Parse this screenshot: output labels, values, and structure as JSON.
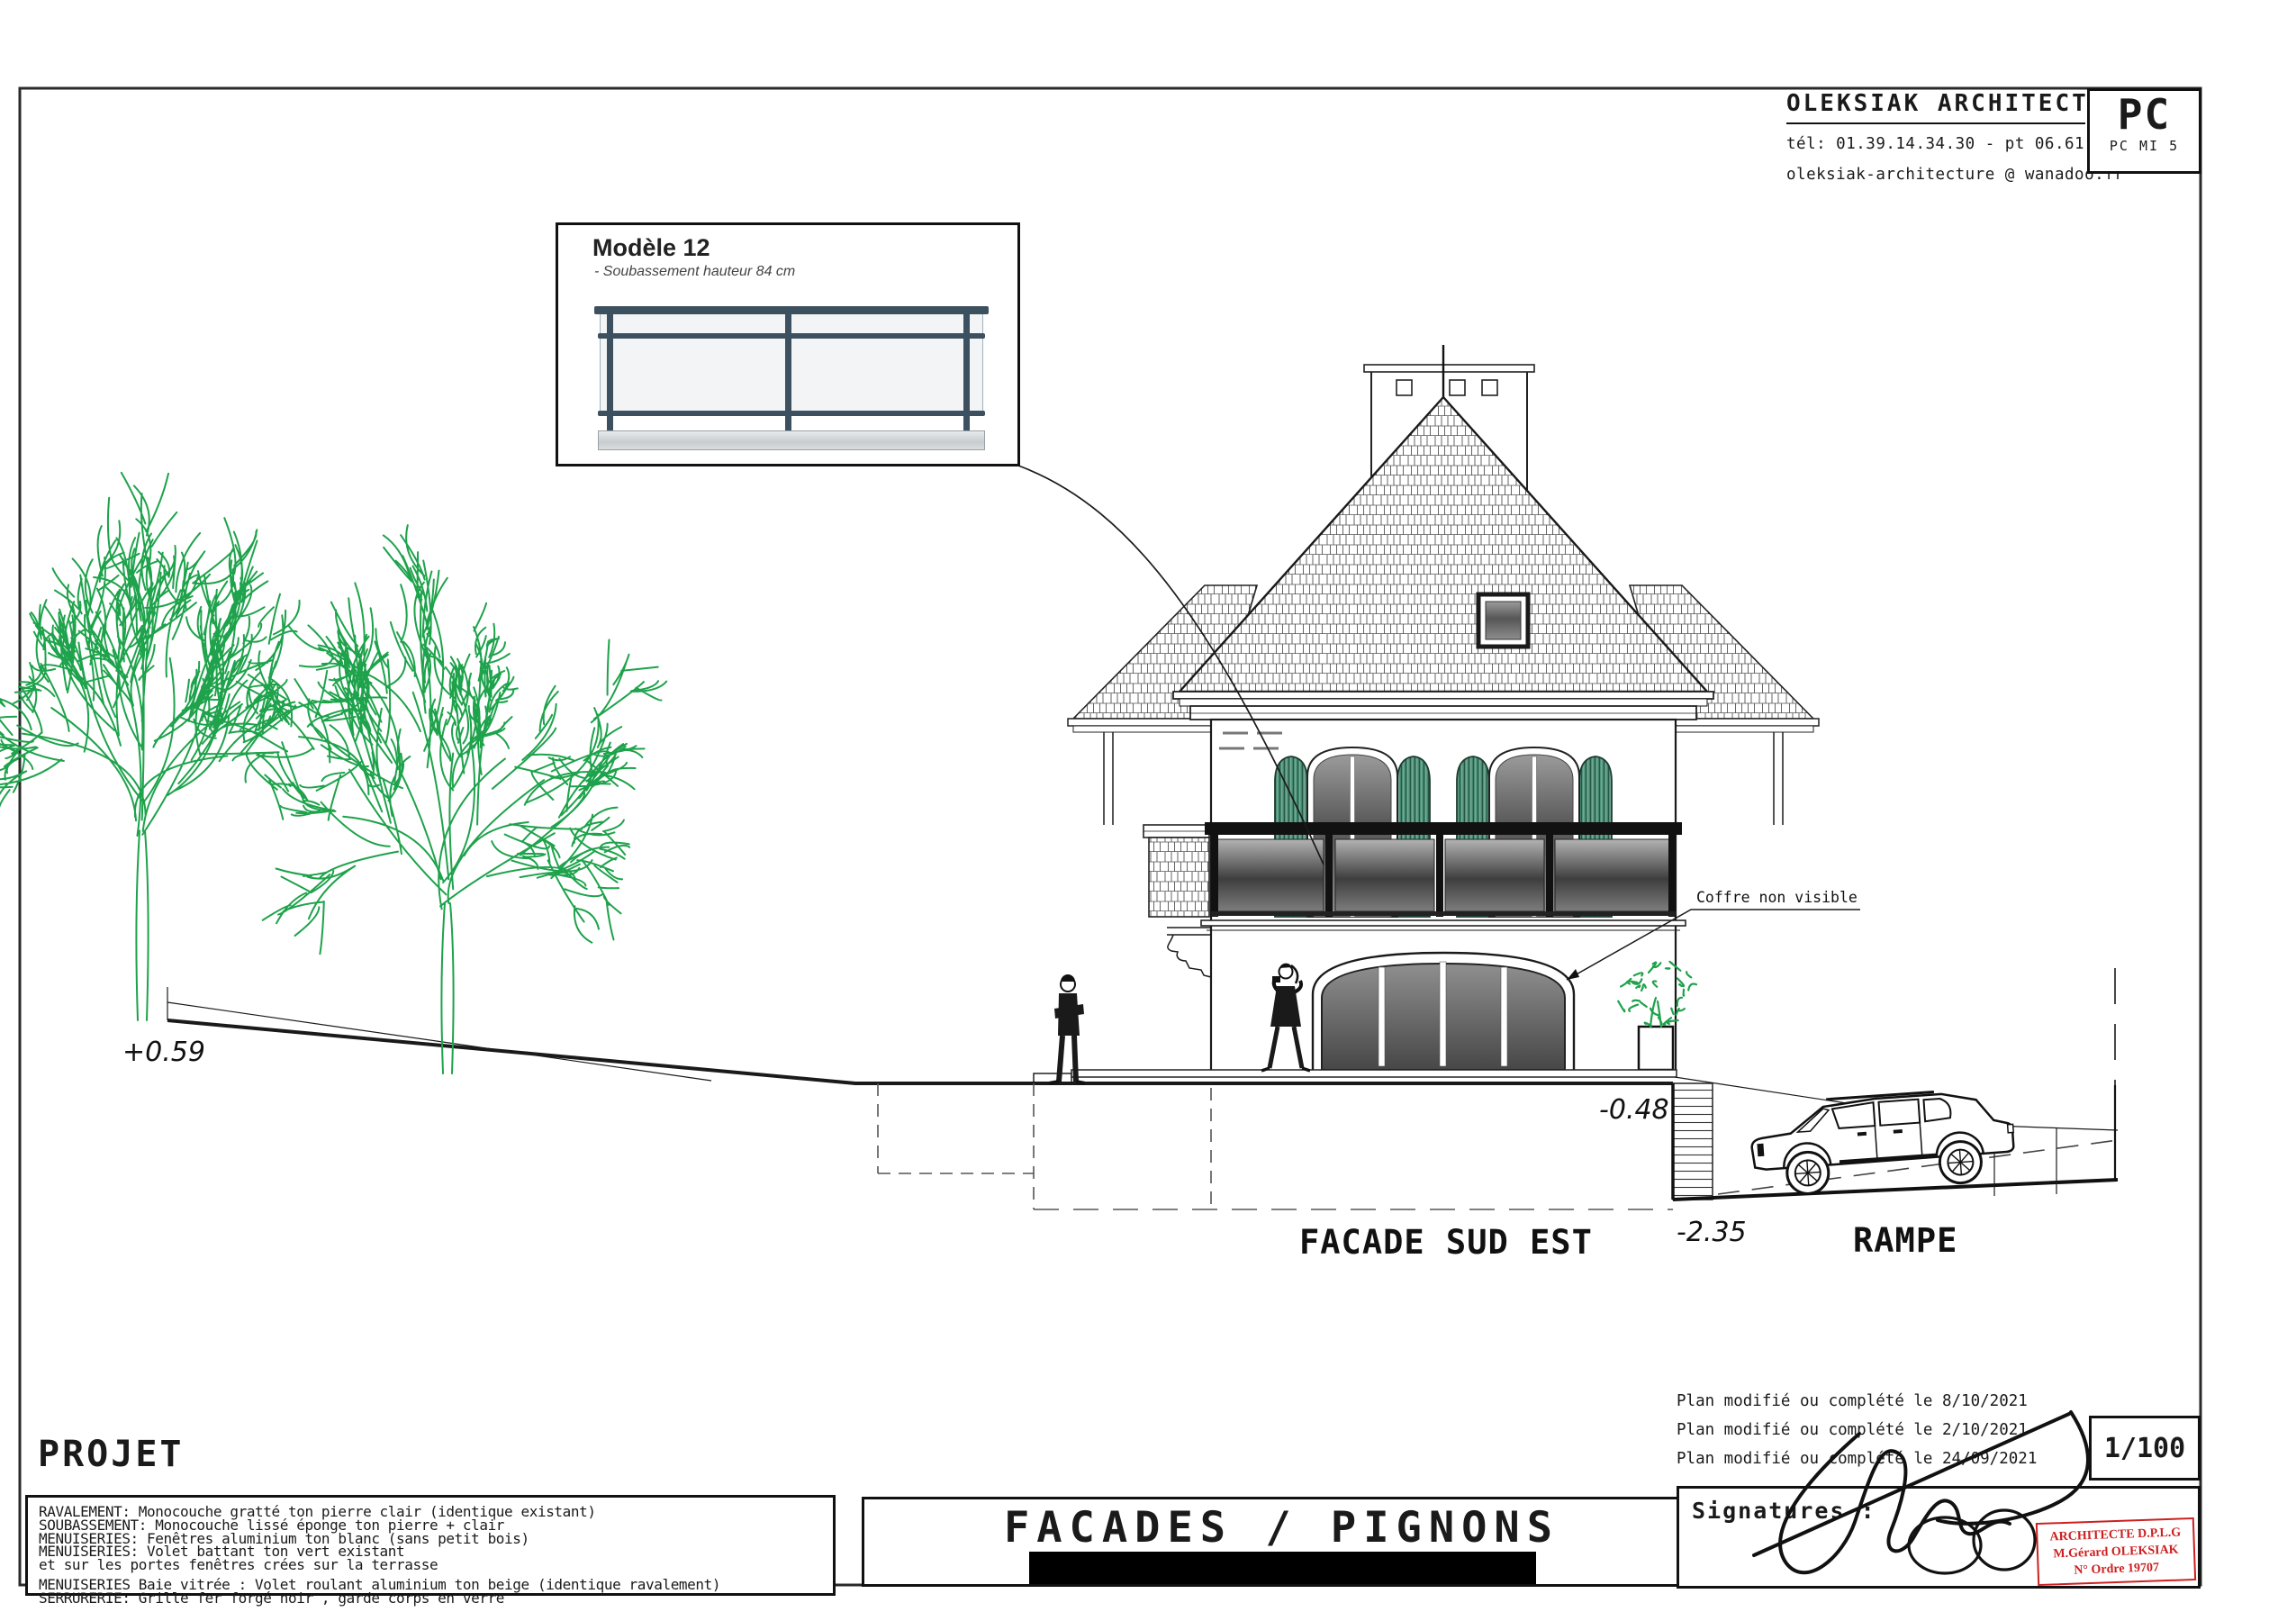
{
  "header": {
    "firm": "OLEKSIAK ARCHITECTURE",
    "phone": "tél: 01.39.14.34.30 - pt 06.61.14.91.86",
    "email": "oleksiak-architecture @ wanadoo.fr",
    "permit_code": "PC",
    "permit_ref": "PC MI 5"
  },
  "model_box": {
    "title": "Modèle 12",
    "subtitle": "- Soubassement hauteur 84 cm"
  },
  "drawing_labels": {
    "coffre": "Coffre non visible",
    "facade": "FACADE SUD EST",
    "rampe": "RAMPE",
    "level_left": "+0.59",
    "level_terrace": "-0.48",
    "level_basement": "-2.35"
  },
  "project": {
    "heading": "PROJET",
    "lines": [
      "RAVALEMENT: Monocouche  gratté ton pierre clair (identique existant)",
      "SOUBASSEMENT: Monocouche  lissé éponge ton pierre + clair",
      "MENUISERIES: Fenêtres aluminium  ton blanc (sans petit bois)",
      "MENUISERIES: Volet battant  ton vert existant",
      "et sur les portes fenêtres crées sur la terrasse",
      "MENUISERIES Baie vitrée : Volet roulant aluminium ton beige (identique ravalement)",
      "SERRURERIE:  Grille fer forgé noir , garde corps en verre"
    ]
  },
  "title_block": {
    "title": "FACADES / PIGNONS"
  },
  "revisions": {
    "lines": [
      "Plan modifié ou complété le 8/10/2021",
      "Plan modifié ou complété le 2/10/2021",
      "Plan modifié ou complété le 24/09/2021"
    ]
  },
  "signatures": {
    "label": "Signatures :"
  },
  "stamp": {
    "line1": "ARCHITECTE D.P.L.G",
    "line2": "M.Gérard OLEKSIAK",
    "line3": "N° Ordre 19707"
  },
  "scale": {
    "value": "1/100"
  },
  "colors": {
    "tree_green": "#1ea24b",
    "shutter_green": "#4e9379",
    "railing_slate": "#3d505f",
    "stamp_red": "#cc2020"
  }
}
